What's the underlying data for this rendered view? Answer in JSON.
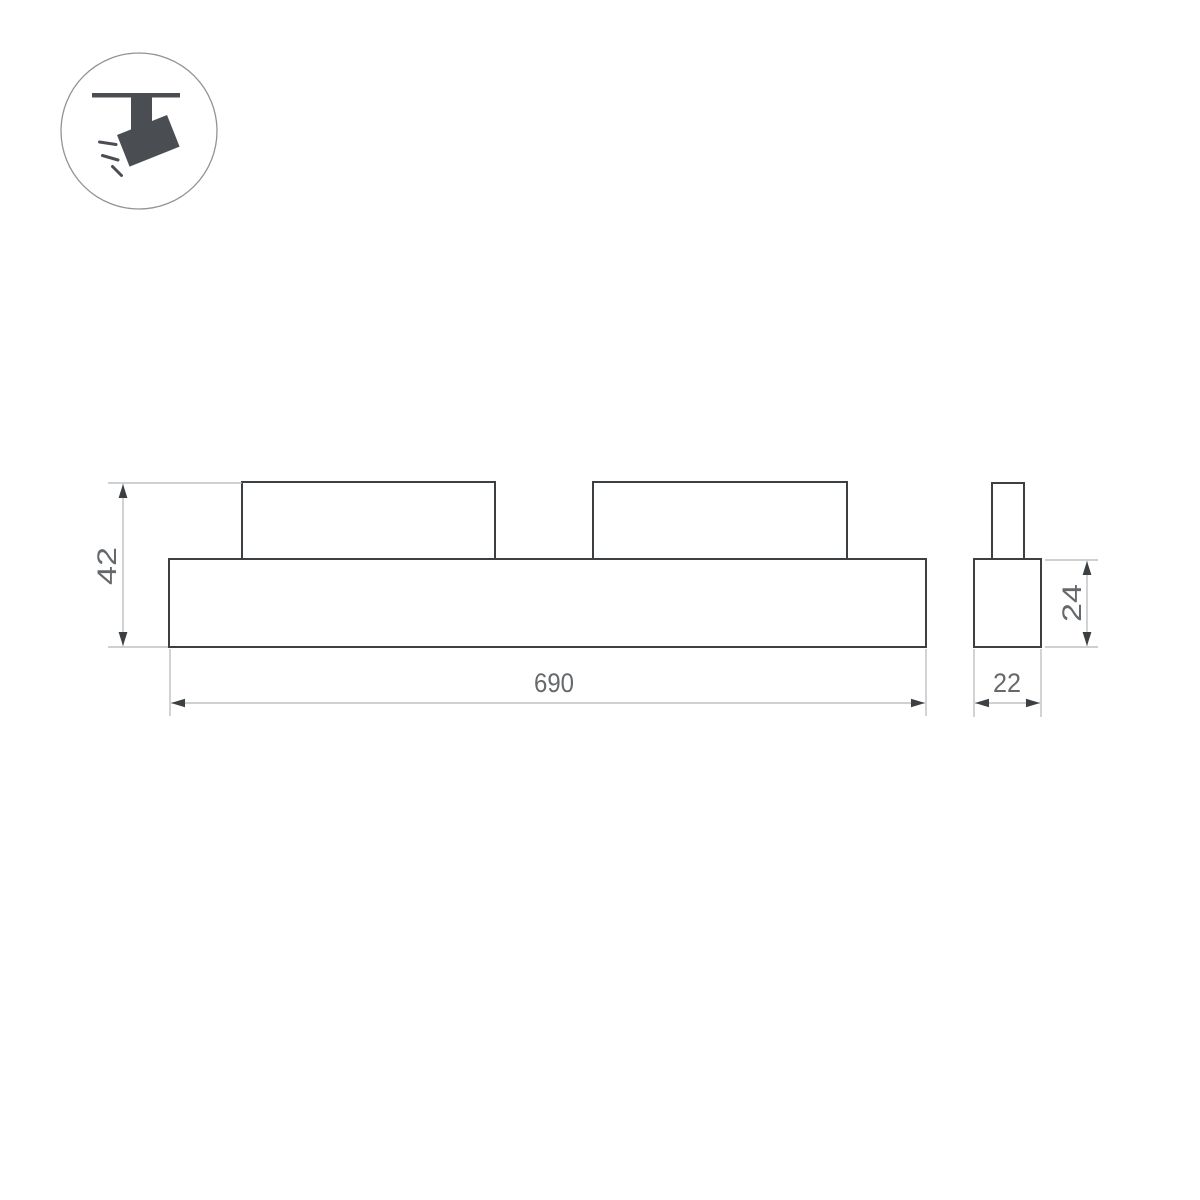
{
  "page": {
    "background_color": "#ffffff"
  },
  "icon": {
    "name": "track-spotlight-icon",
    "glyph_color": "#4a4e53",
    "circle_border_color": "#909496"
  },
  "drawing": {
    "outline_color": "#3c4043",
    "dim_line_color": "#b2b5b7",
    "dim_text_color": "#66696c",
    "arrow_color": "#3c4043",
    "front_view": {
      "length_label": "690",
      "height_label": "42"
    },
    "side_view": {
      "width_label": "22",
      "height_label": "24"
    }
  }
}
